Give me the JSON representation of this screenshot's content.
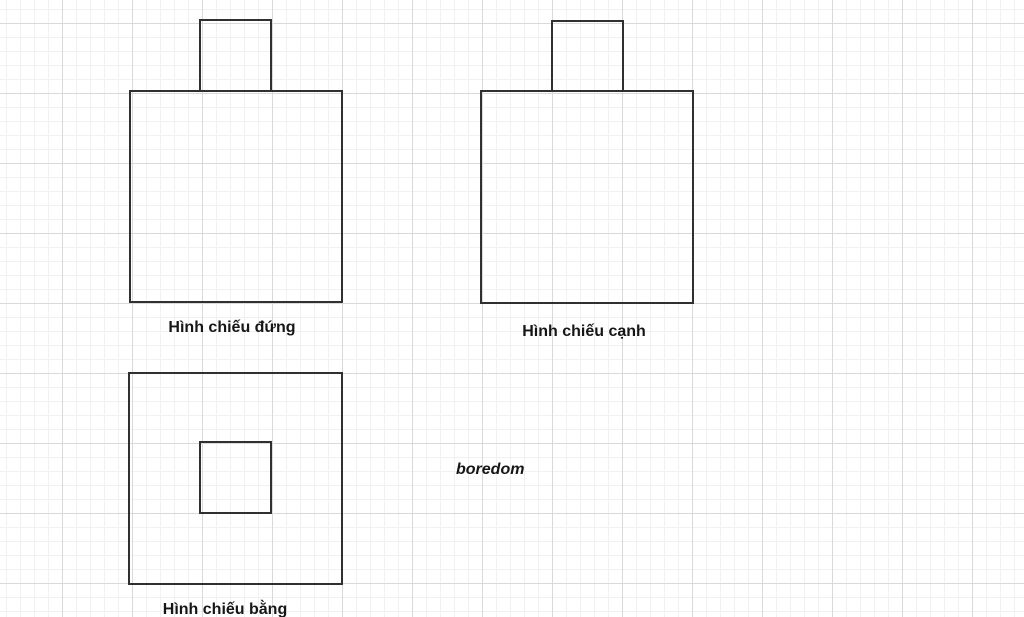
{
  "canvas": {
    "background_color": "#ffffff",
    "grid": {
      "minor_spacing_px": 14,
      "major_spacing_px": 70,
      "minor_color": "#f1f1f1",
      "major_color": "#d9d9d9"
    },
    "stroke_color": "#303030",
    "text_color": "#161616"
  },
  "shapes": [
    {
      "id": "front-view",
      "kind": "square-with-top-tab",
      "label": "Hình chiếu đứng"
    },
    {
      "id": "side-view",
      "kind": "square-with-top-tab",
      "label": "Hình chiếu cạnh"
    },
    {
      "id": "top-view",
      "kind": "square-with-inner-square",
      "label": "Hình chiếu bằng"
    }
  ],
  "annotation": {
    "text": "boredom"
  }
}
